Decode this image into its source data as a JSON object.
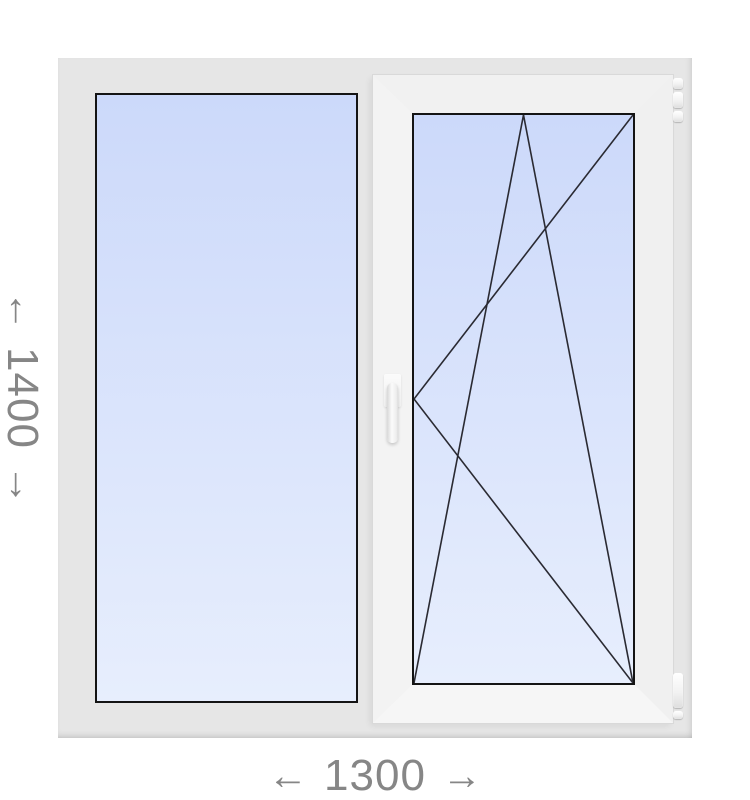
{
  "colors": {
    "page_bg": "#ffffff",
    "frame_bg": "#e6e6e6",
    "sash_face": "#f3f3f3",
    "glass_top": "#ccd9fa",
    "glass_bottom": "#e7eefd",
    "glass_border": "#141414",
    "opening_lines": "#2a2a32",
    "dimension_text": "#868686"
  },
  "dimensions": {
    "height": {
      "arrow_start": "←",
      "value": "1400",
      "arrow_end": "→"
    },
    "width": {
      "arrow_start": "←",
      "value": "1300",
      "arrow_end": "→"
    }
  },
  "window": {
    "panes": [
      {
        "type": "fixed glazing",
        "position": "left"
      },
      {
        "type": "tilt-and-turn sash",
        "position": "right",
        "handle_side": "left",
        "hinge_side": "right"
      }
    ]
  }
}
